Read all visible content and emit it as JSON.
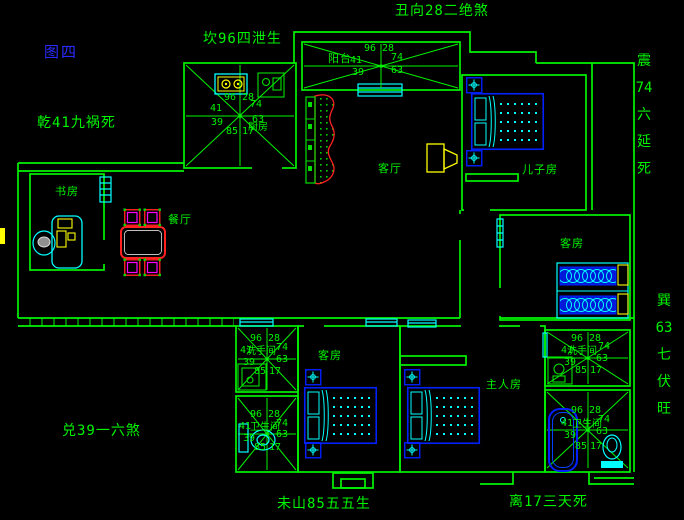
{
  "figure_label": "图四",
  "annotations": {
    "north": "坎96四泄生",
    "northeast": "丑向28二绝煞",
    "northwest": "乾41九祸死",
    "west": "兑39一六煞",
    "southwest": "未山85五五生",
    "south": "离17三天死",
    "east_vertical": [
      "震",
      "74",
      "六",
      "延",
      "死"
    ],
    "southeast_vertical": [
      "巽",
      "63",
      "七",
      "伏",
      "旺"
    ]
  },
  "rooms": {
    "kitchen": "厨房",
    "balcony": "阳台",
    "living": "客厅",
    "dining": "餐厅",
    "study": "书房",
    "sons_room": "儿子房",
    "guest_right": "客房",
    "guest_bottom": "客房",
    "master": "主人房",
    "washroom_left": "洗手间",
    "bathroom_left": "卫生间",
    "washroom_right": "洗手间",
    "bathroom_right": "卫生间"
  },
  "compass": [
    "96",
    "28",
    "41",
    "74",
    "39",
    "63",
    "85",
    "17"
  ],
  "colors": {
    "background": "#000000",
    "wall_green": "#00F400",
    "window_cyan": "#00FFFF",
    "furniture_blue": "#0020FF",
    "accent_yellow": "#FFFF00",
    "accent_red": "#FF2020",
    "accent_magenta": "#FF00FF",
    "figure_label_blue": "#2A2AFF"
  }
}
